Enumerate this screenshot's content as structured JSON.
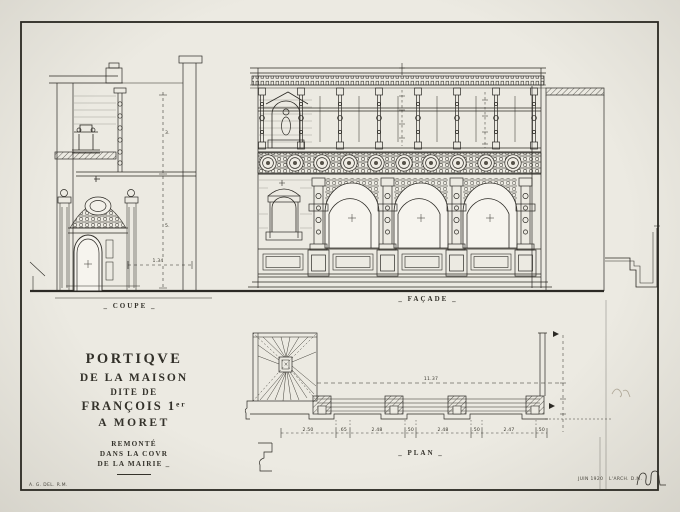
{
  "drawing": {
    "labels": {
      "coupe": "_ COUPE _",
      "facade": "_ FAÇADE _",
      "plan": "_ PLAN _"
    },
    "title_block": {
      "line1": "PORTIQVE",
      "line2": "DE LA MAISON",
      "line3": "DITE DE",
      "line4": "FRANÇOIS 1ᵉʳ",
      "line5": "A MORET",
      "line6": "REMONTÉ",
      "line7": "DANS LA COVR",
      "line8": "DE LA MAIRIE _"
    },
    "credits": {
      "bottom_left": "A. G. DEL. R.M.",
      "date": "JUIN 1920",
      "architect": "L'ARCH. D.M."
    },
    "dimensions": {
      "coupe_upper": "3.",
      "coupe_lower": "5.",
      "coupe_width": "1.34",
      "plan_total": "11.37",
      "plan_row": [
        "2.50",
        ".65",
        "2.48",
        ".50",
        "2.48",
        ".50",
        "2.47",
        ".50"
      ]
    }
  }
}
